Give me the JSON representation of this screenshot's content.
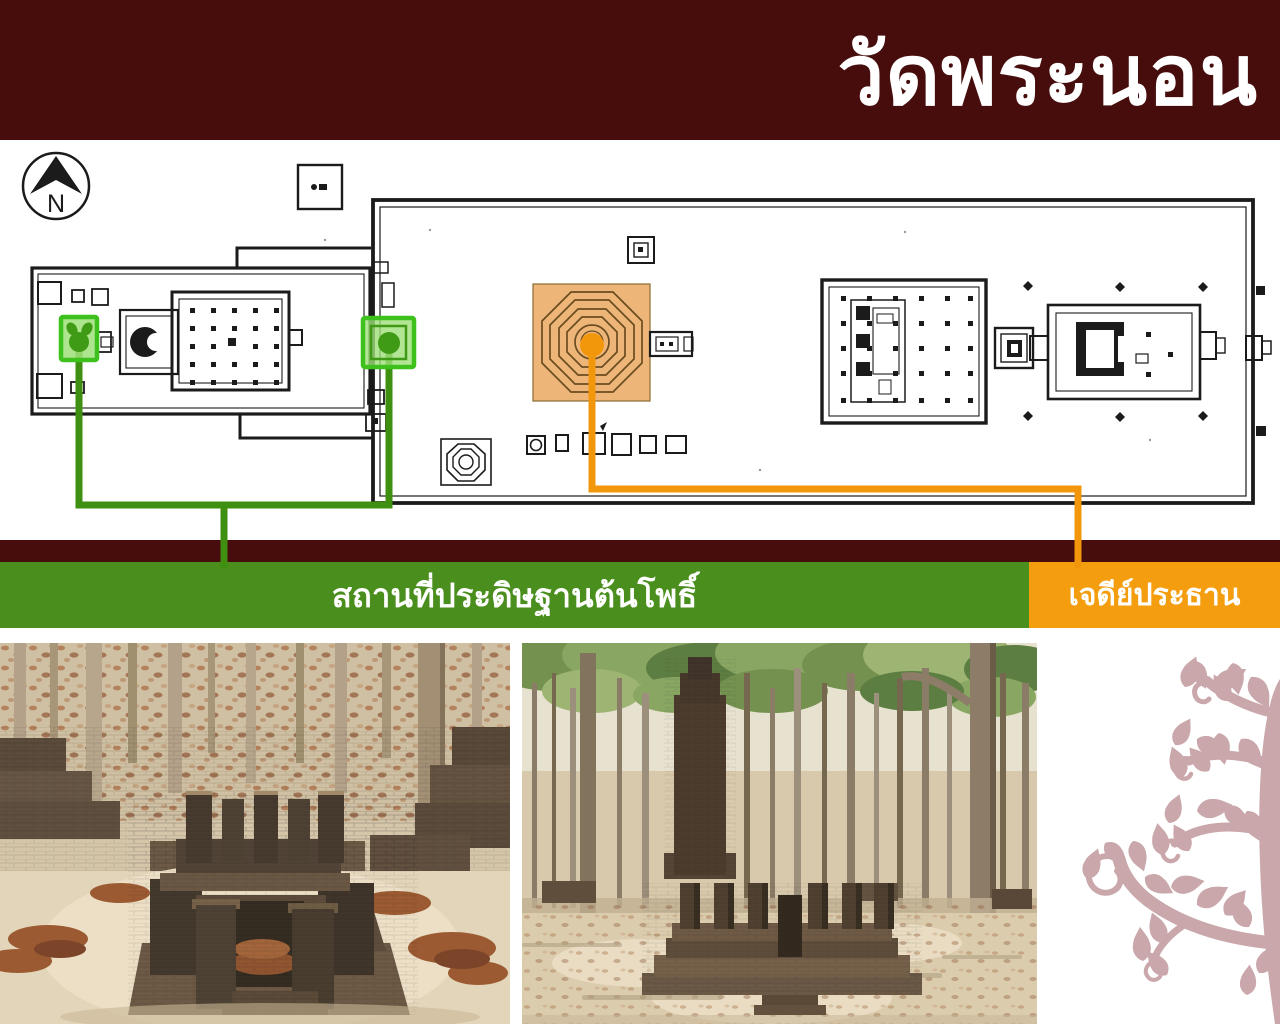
{
  "header": {
    "title": "วัดพระนอน"
  },
  "plan": {
    "compass_label": "N"
  },
  "labels": {
    "bodhi": "สถานที่ประดิษฐานต้นโพธิ์",
    "chedi": "เจดีย์ประธาน"
  },
  "colors": {
    "header_bg": "#470d0d",
    "divider": "#470d0d",
    "green_label": "#4a8e1d",
    "orange_label": "#f39d0f",
    "green_highlight_border": "#3fc11d",
    "green_highlight_fill": "#9fe07a",
    "green_marker": "#3f9a15",
    "green_line": "#3f8f11",
    "orange_highlight_fill": "#edb678",
    "orange_line": "#f2970b",
    "plan_ink": "#1b1b1b",
    "bodhi_tree_motif": "#c9a7aa",
    "page_bg": "#ffffff"
  }
}
